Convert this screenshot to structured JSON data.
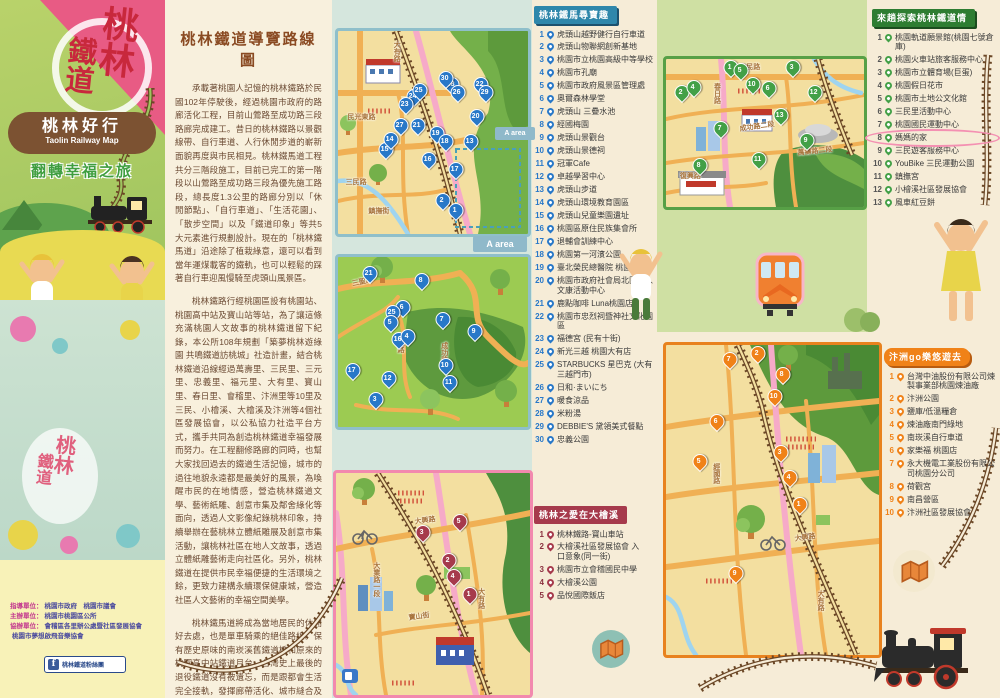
{
  "colors": {
    "accent_pink": "#e85b84",
    "brand_brown": "#7c5232",
    "blue_pin": "#2878c8",
    "green_pin": "#43a047",
    "orange_accent": "#f08218",
    "dark_red": "#a63a4c",
    "teal_border": "#8fbfca"
  },
  "cover": {
    "logo_line1": "桃林",
    "logo_line2": "鐵道",
    "title": "桃林好行",
    "title_en": "Taolin Railway Map",
    "subtitle": "翻轉幸福之旅",
    "credits": [
      {
        "label": "指導單位：",
        "value": "桃園市政府　桃園市議會"
      },
      {
        "label": "主辦單位：",
        "value": "桃園市桃園區公所"
      },
      {
        "label": "協辦單位：",
        "value": "會稽區各里辦公處暨社區發展協會"
      },
      {
        "label": "",
        "value": "桃園市夢想啟飛音樂協會"
      }
    ],
    "fb_label": "桃林鐵道粉絲團",
    "fb_icon": "f"
  },
  "intro": {
    "title": "桃林鐵道導覽路線圖",
    "p1": "承載著桃園人記憶的桃林鐵路於民國102年停駛後，經過桃園市政府的路廊活化工程，目前山鶯路至成功路三段路廊完成建工。昔日的桃林鐵路以景觀線帶、自行車道、人行休閒步道的嶄新面貌再度與市民相見。桃林鐵馬道工程共分三階段施工，目前已完工的第一階段以山鶯路至成功路三段為優先施工路段，總長度1.3公里的路廊分別以「休閒節點」、「自行車道」、「生活花園」、「散步空間」以及「鐵道印象」等共5大元素進行規劃設計。現在的「桃林鐵馬道」沿途除了植栽綠意，還可以看到當年運煤載客的鐵軌，也可以輕鬆的踩著自行車迎風慢騎至虎頭山風景區。",
    "p2": "桃林鐵路行經桃園區設有桃園站、桃園高中站及寶山站等站，為了讓這條充滿桃園人文故事的桃林鐵道留下紀錄，本公所108年規劃「築夢桃林遊綠園 共鳴鐵道訪桃城」社造計畫，結合桃林鐵道沿線經過萬壽里、三民里、三元里、忠義里、福元里、大有里、寶山里、春日里、會稽里、汴洲里等10里及三民、小檜溪、大檜溪及汴洲等4個社區發展協會，以公私協力社造平台方式，攜手共同為創造桃林鐵道幸福發展而努力。在工程翻修路廊的同時，也幫大家找回過去的鐵道生活記憶，城市的過往地貌永遠都是最美好的風景，為喚醒市民的在地情感，營造桃林鐵道文學、藝術紙雕、創意市集及鄰舍綠化等面向，透過人文影像紀錄桃林印象，持續舉辦在藝桃林立體紙雕展及創意市集活動，讓桃林社區在地人文故事，透過立體紙雕藝術走向社區化。另外，桃林鐵道在提供市民幸福便捷的生活環境之餘，更致力建構永續環保健康城，營造社區人文藝術的幸福空間美學。",
    "p3": "桃林鐵馬道將成為當地居民的休閒好去處，也是單車騎乘的絕佳路線。保有歷史原味的南崁溪舊鐵道橋和原來的桃園高中站鐵道月台，台灣史上最後的退役鐵道沒有被遺忘，而是跟都會生活完全接軌，發揮廊帶活化、城市縫合及鐵道再利用的加乘效果與價值。"
  },
  "list_blue": {
    "title": "桃林鐵馬尋寶趣",
    "items": [
      "虎頭山越野健行自行車道",
      "虎頭山物聯網創新基地",
      "桃園市立桃園高級中等學校",
      "桃園市孔廟",
      "桃園市政府風景區管理處",
      "奧爾森林學堂",
      "虎頭山 三疊水池",
      "經國梅園",
      "虎頭山景觀台",
      "虎頭山景德祠",
      "冠軍Cafe",
      "卓越學習中心",
      "虎頭山步道",
      "虎頭山環境教育園區",
      "虎頭山兒童樂園遺址",
      "桃園區原住民族集會所",
      "退輔會訓練中心",
      "桃園第一河濱公園",
      "臺北榮民總醫院 桃園分院",
      "桃園市政府社會局北區老人文康活動中心",
      "鹿點咖啡 Luna桃園店",
      "桃園市忠烈祠暨神社文化園區",
      "福德宮 (民有十街)",
      "新光三越 桃園大有店",
      "STARBUCKS 星巴克 (大有三越門市)",
      "日和·まいにち",
      "暖食涼品",
      "米粉湯",
      "DEBBIE'S 黛領美式餐點",
      "忠義公園"
    ]
  },
  "list_green": {
    "title": "來趟探索桃林鐵道情",
    "highlight_index": 8,
    "items": [
      "桃園軌道願景館(桃園七號倉庫)",
      "桃園火車站旅客服務中心",
      "桃園市立體育場(巨蛋)",
      "桃園假日花市",
      "桃園市土地公文化館",
      "三民里活動中心",
      "桃園國民運動中心",
      "媽媽的家",
      "三民遊客服務中心",
      "YouBike 三民運動公園",
      "鎮撫宮",
      "小檜溪社區發展協會",
      "風車紅豆餅"
    ]
  },
  "list_orange": {
    "title": "汴洲go樂悠遊去",
    "items": [
      "台灣中油股份有限公司煉製事業部桃園煉油廠",
      "汴洲公園",
      "鹽庫/低溫糧倉",
      "煉油廠南門綠地",
      "南崁溪自行車道",
      "家樂福 桃園店",
      "永大機電工業股份有限公司桃園分公司",
      "荷觀宮",
      "南昌營區",
      "汴洲社區發展協會"
    ]
  },
  "list_red": {
    "title": "桃林之愛在大檜溪",
    "items": [
      "桃林鐵路-寶山車站",
      "大檜溪社區發展協會 入口意象(同一街)",
      "桃園市立會稽國民中學",
      "大檜溪公園",
      "品悅國際飯店"
    ]
  },
  "maps": {
    "a_area": "A area",
    "map1": {
      "roads": [
        {
          "t": "大有路",
          "x": 28,
          "y": 5,
          "v": 1
        },
        {
          "t": "民光東路",
          "x": 5,
          "y": 40
        },
        {
          "t": "三民路",
          "x": 4,
          "y": 72
        },
        {
          "t": "鎮撫街",
          "x": 16,
          "y": 86
        }
      ],
      "markers": [
        {
          "n": 28,
          "x": 60,
          "y": 30
        },
        {
          "n": 26,
          "x": 63,
          "y": 34
        },
        {
          "n": 24,
          "x": 40,
          "y": 36
        },
        {
          "n": 25,
          "x": 43,
          "y": 33
        },
        {
          "n": 30,
          "x": 57,
          "y": 27
        },
        {
          "n": 23,
          "x": 36,
          "y": 40
        },
        {
          "n": 22,
          "x": 75,
          "y": 30
        },
        {
          "n": 29,
          "x": 78,
          "y": 34
        },
        {
          "n": 20,
          "x": 73,
          "y": 46
        },
        {
          "n": 27,
          "x": 33,
          "y": 50
        },
        {
          "n": 21,
          "x": 42,
          "y": 50
        },
        {
          "n": 19,
          "x": 52,
          "y": 54
        },
        {
          "n": 18,
          "x": 57,
          "y": 58
        },
        {
          "n": 13,
          "x": 70,
          "y": 58
        },
        {
          "n": 17,
          "x": 62,
          "y": 72
        },
        {
          "n": 16,
          "x": 48,
          "y": 67
        },
        {
          "n": 15,
          "x": 25,
          "y": 62
        },
        {
          "n": 14,
          "x": 28,
          "y": 57
        },
        {
          "n": 2,
          "x": 55,
          "y": 87
        },
        {
          "n": 1,
          "x": 62,
          "y": 92
        }
      ]
    },
    "map2": {
      "roads": [
        {
          "t": "三聖路",
          "x": 7,
          "y": 13,
          "rot": -12
        },
        {
          "t": "公園路",
          "x": 30,
          "y": 44,
          "v": 1
        },
        {
          "t": "成功路",
          "x": 53,
          "y": 50,
          "v": 1
        }
      ],
      "markers": [
        {
          "n": 21,
          "x": 17,
          "y": 14
        },
        {
          "n": 8,
          "x": 44,
          "y": 18
        },
        {
          "n": 6,
          "x": 34,
          "y": 34
        },
        {
          "n": 25,
          "x": 29,
          "y": 37
        },
        {
          "n": 5,
          "x": 28,
          "y": 43
        },
        {
          "n": 16,
          "x": 32,
          "y": 53
        },
        {
          "n": 4,
          "x": 37,
          "y": 51
        },
        {
          "n": 7,
          "x": 55,
          "y": 41
        },
        {
          "n": 9,
          "x": 72,
          "y": 48
        },
        {
          "n": 10,
          "x": 57,
          "y": 68
        },
        {
          "n": 11,
          "x": 59,
          "y": 78
        },
        {
          "n": 17,
          "x": 8,
          "y": 71
        },
        {
          "n": 12,
          "x": 27,
          "y": 76
        },
        {
          "n": 3,
          "x": 20,
          "y": 88
        }
      ]
    },
    "map3": {
      "roads": [
        {
          "t": "大興路",
          "x": 40,
          "y": 20,
          "rot": -8
        },
        {
          "t": "大業路一段",
          "x": 18,
          "y": 40,
          "v": 1
        },
        {
          "t": "寶山街",
          "x": 37,
          "y": 63,
          "rot": -8
        },
        {
          "t": "大有路",
          "x": 72,
          "y": 52,
          "v": 1
        }
      ],
      "markers": [
        {
          "n": 3,
          "x": 45,
          "y": 30
        },
        {
          "n": 5,
          "x": 64,
          "y": 25
        },
        {
          "n": 2,
          "x": 58,
          "y": 43
        },
        {
          "n": 4,
          "x": 61,
          "y": 50
        },
        {
          "n": 1,
          "x": 69,
          "y": 58
        }
      ]
    },
    "map4": {
      "roads": [
        {
          "t": "三民路",
          "x": 37,
          "y": 2
        },
        {
          "t": "春日路",
          "x": 23,
          "y": 16,
          "v": 1
        },
        {
          "t": "成功路二段",
          "x": 37,
          "y": 44,
          "rot": -8
        },
        {
          "t": "萬壽路二段",
          "x": 66,
          "y": 60,
          "rot": -6
        },
        {
          "t": "復興路",
          "x": 7,
          "y": 76
        }
      ],
      "markers": [
        {
          "n": 1,
          "x": 33,
          "y": 11
        },
        {
          "n": 2,
          "x": 8,
          "y": 28
        },
        {
          "n": 4,
          "x": 14,
          "y": 24
        },
        {
          "n": 5,
          "x": 38,
          "y": 13
        },
        {
          "n": 10,
          "x": 44,
          "y": 22
        },
        {
          "n": 6,
          "x": 52,
          "y": 25
        },
        {
          "n": 3,
          "x": 64,
          "y": 11
        },
        {
          "n": 12,
          "x": 75,
          "y": 28
        },
        {
          "n": 13,
          "x": 58,
          "y": 43
        },
        {
          "n": 9,
          "x": 71,
          "y": 60
        },
        {
          "n": 7,
          "x": 28,
          "y": 52
        },
        {
          "n": 11,
          "x": 47,
          "y": 73
        },
        {
          "n": 8,
          "x": 17,
          "y": 77
        }
      ]
    },
    "map5": {
      "roads": [
        {
          "t": "經國路",
          "x": 21,
          "y": 38,
          "v": 1
        },
        {
          "t": "大興路",
          "x": 60,
          "y": 61,
          "rot": -8
        },
        {
          "t": "大有路",
          "x": 70,
          "y": 79,
          "v": 1
        }
      ],
      "markers": [
        {
          "n": 7,
          "x": 30,
          "y": 7
        },
        {
          "n": 2,
          "x": 43,
          "y": 5
        },
        {
          "n": 8,
          "x": 55,
          "y": 12
        },
        {
          "n": 10,
          "x": 51,
          "y": 19
        },
        {
          "n": 6,
          "x": 24,
          "y": 27
        },
        {
          "n": 5,
          "x": 16,
          "y": 40
        },
        {
          "n": 3,
          "x": 54,
          "y": 37
        },
        {
          "n": 4,
          "x": 58,
          "y": 45
        },
        {
          "n": 1,
          "x": 63,
          "y": 54
        },
        {
          "n": 9,
          "x": 33,
          "y": 76
        }
      ]
    }
  }
}
